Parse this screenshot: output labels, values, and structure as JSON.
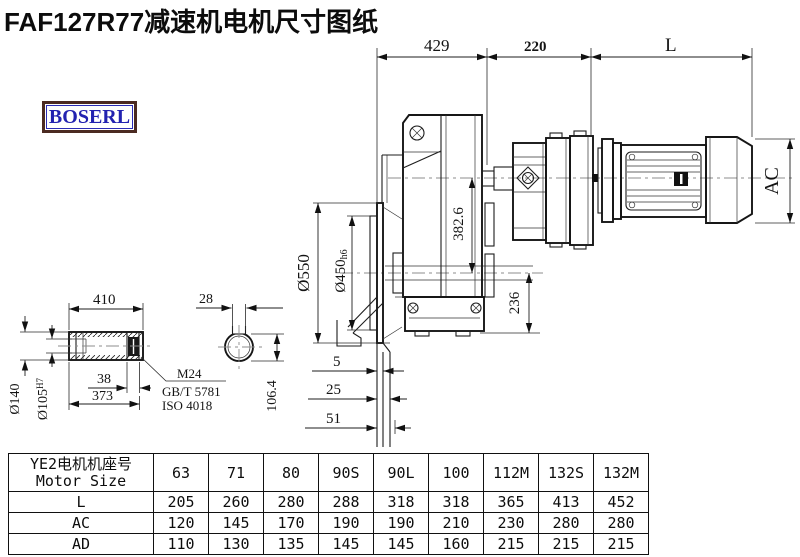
{
  "header": {
    "title": "FAF127R77减速机电机尺寸图纸",
    "brand": "BOSERL"
  },
  "drawing": {
    "dim_429": "429",
    "dim_220": "220",
    "dim_L": "L",
    "dim_AC": "AC",
    "dim_382_6": "382.6",
    "dim_550": "Ø550",
    "dim_450": "Ø450",
    "dim_450_tol": "h6",
    "dim_236": "236",
    "dim_5": "5",
    "dim_25": "25",
    "dim_51": "51",
    "dim_410": "410",
    "dim_38": "38",
    "dim_373": "373",
    "dim_140": "Ø140",
    "dim_105": "Ø105",
    "dim_105_tol": "H7",
    "dim_28": "28",
    "dim_106_4": "106.4",
    "note_thread": "M24",
    "note_std1": "GB/T 5781",
    "note_std2": "ISO 4018"
  },
  "table": {
    "header_cn": "YE2电机机座号",
    "header_en": "Motor Size",
    "columns": [
      "63",
      "71",
      "80",
      "90S",
      "90L",
      "100",
      "112M",
      "132S",
      "132M"
    ],
    "rows": [
      {
        "label": "L",
        "values": [
          "205",
          "260",
          "280",
          "288",
          "318",
          "318",
          "365",
          "413",
          "452"
        ]
      },
      {
        "label": "AC",
        "values": [
          "120",
          "145",
          "170",
          "190",
          "190",
          "210",
          "230",
          "280",
          "280"
        ]
      },
      {
        "label": "AD",
        "values": [
          "110",
          "130",
          "135",
          "145",
          "145",
          "160",
          "215",
          "215",
          "215"
        ]
      }
    ]
  }
}
